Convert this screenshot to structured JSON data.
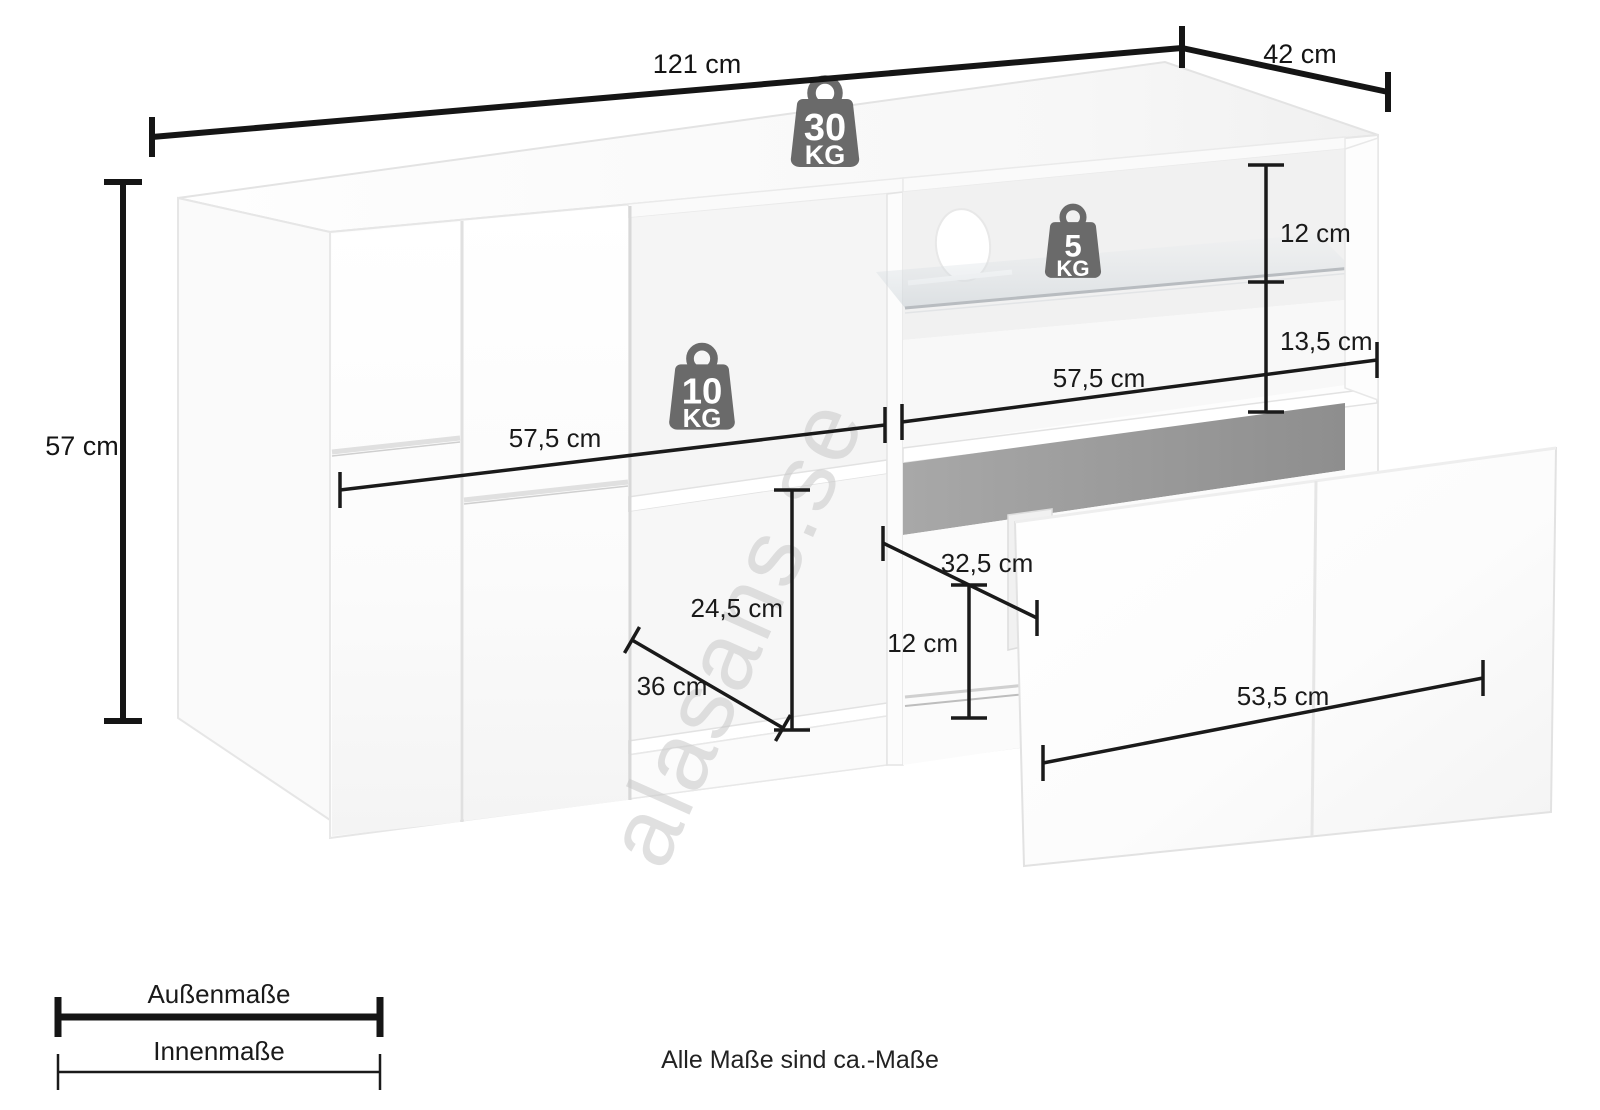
{
  "watermark": {
    "text": "alasans.se"
  },
  "footnote": {
    "text": "Alle Maße sind ca.-Maße"
  },
  "legend": {
    "outer_label": "Außenmaße",
    "inner_label": "Innenmaße"
  },
  "outer_dimensions": {
    "width": {
      "label": "121 cm"
    },
    "depth": {
      "label": "42 cm"
    },
    "height": {
      "label": "57 cm"
    }
  },
  "inner_dimensions": {
    "left_compartment_width": {
      "label": "57,5 cm"
    },
    "left_compartment_height": {
      "label": "24,5 cm"
    },
    "left_compartment_depth": {
      "label": "36 cm"
    },
    "right_compartment_width": {
      "label": "57,5 cm"
    },
    "above_glass_shelf": {
      "label": "12 cm"
    },
    "below_glass_shelf": {
      "label": "13,5 cm"
    },
    "drawer_inner_depth": {
      "label": "32,5 cm"
    },
    "drawer_inner_height": {
      "label": "12 cm"
    },
    "drawer_front_width": {
      "label": "53,5 cm"
    }
  },
  "max_load_badges": {
    "top_panel": {
      "value": "30",
      "unit": "KG"
    },
    "middle_shelf": {
      "value": "10",
      "unit": "KG"
    },
    "glass_shelf": {
      "value": "5",
      "unit": "KG"
    }
  },
  "colors": {
    "dimension_line": "#1a1a1a",
    "badge": "#6a6a6a",
    "drawer_opening": "#9a9a9a"
  }
}
